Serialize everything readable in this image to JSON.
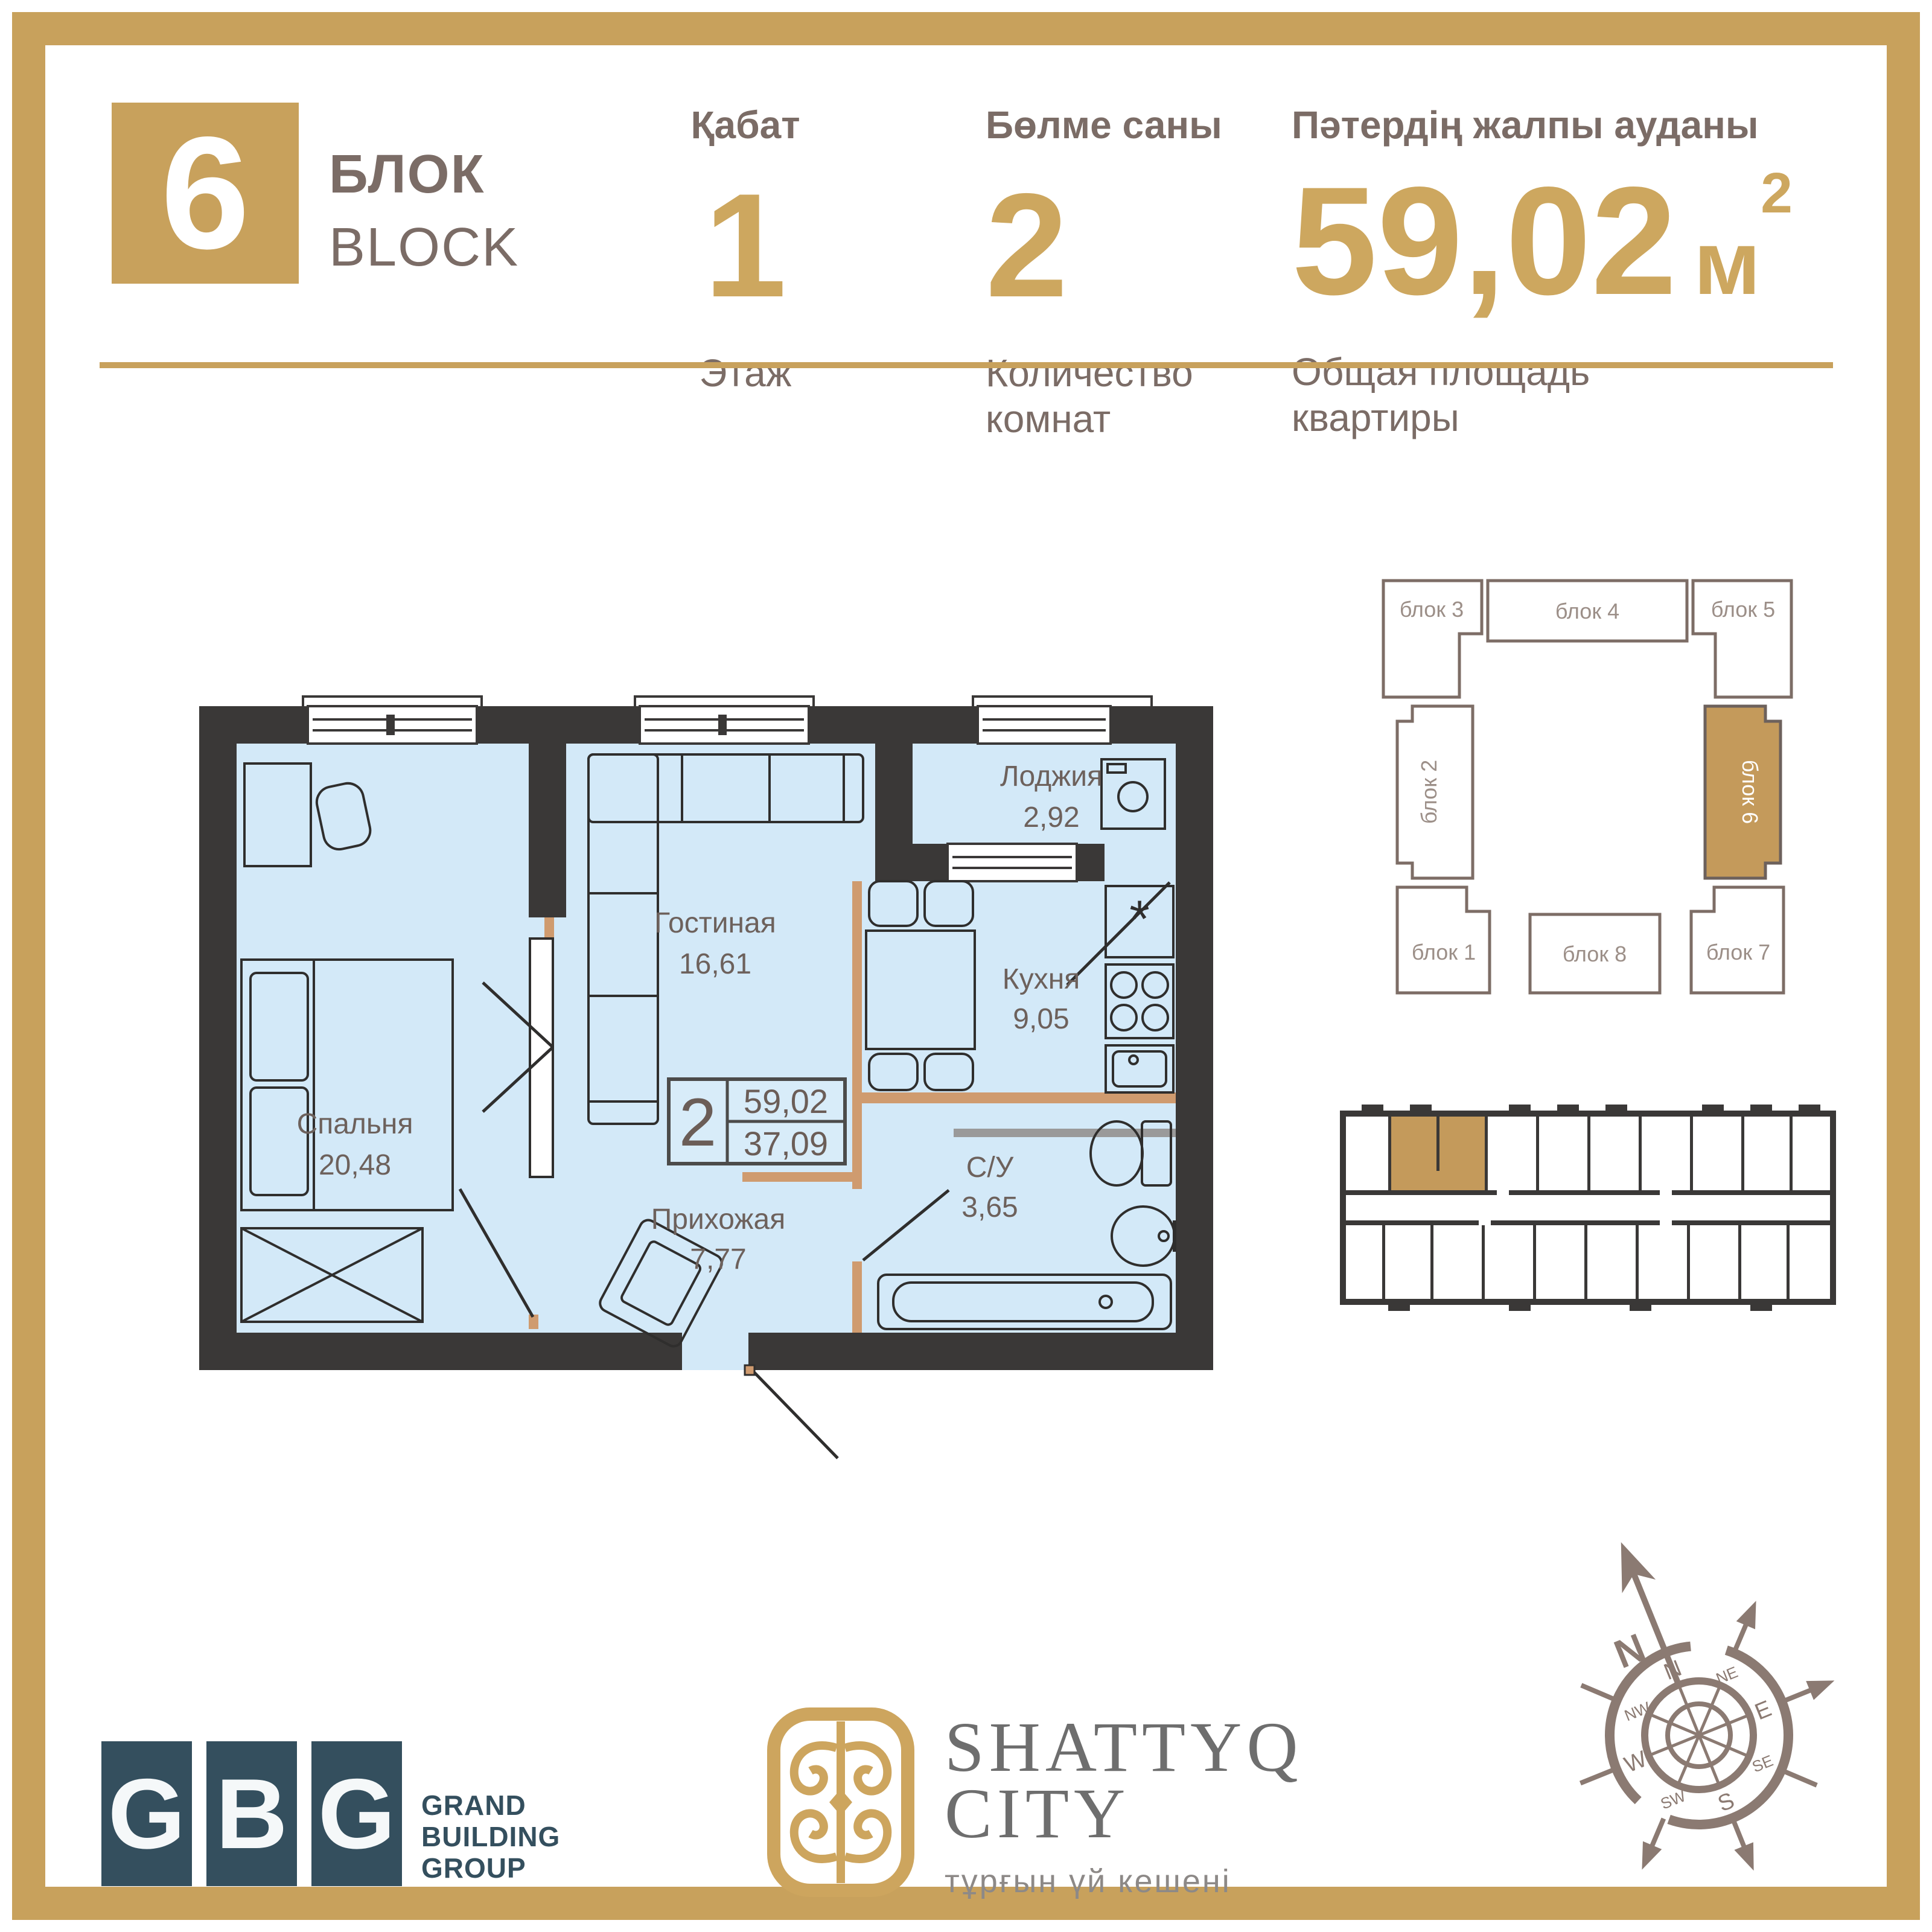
{
  "header": {
    "block_number": "6",
    "block_label_kk": "БЛОК",
    "block_label_en": "BLOCK",
    "floor": {
      "label_kk": "Қабат",
      "value": "1",
      "label_ru": "Этаж"
    },
    "rooms": {
      "label_kk": "Бөлме саны",
      "value": "2",
      "label_ru": "Количество комнат"
    },
    "area": {
      "label_kk": "Пәтердің жалпы ауданы",
      "value": "59,02",
      "unit": "м",
      "sup": "2",
      "label_ru_1": "Общая площадь",
      "label_ru_2": "квартиры"
    }
  },
  "floor_plan": {
    "rooms": [
      {
        "name": "Лоджия",
        "area": "2,92"
      },
      {
        "name": "Гостиная",
        "area": "16,61"
      },
      {
        "name": "Кухня",
        "area": "9,05"
      },
      {
        "name": "Спальня",
        "area": "20,48"
      },
      {
        "name": "Прихожая",
        "area": "7,77"
      },
      {
        "name": "С/У",
        "area": "3,65"
      }
    ],
    "info_box": {
      "rooms": "2",
      "total_area": "59,02",
      "living_area": "37,09"
    },
    "fridge_symbol": "*"
  },
  "block_scheme": {
    "blocks": [
      {
        "label": "блок 3"
      },
      {
        "label": "блок 4"
      },
      {
        "label": "блок 5"
      },
      {
        "label": "блок 2"
      },
      {
        "label": "блок 6",
        "highlighted": true
      },
      {
        "label": "блок 1"
      },
      {
        "label": "блок 8"
      },
      {
        "label": "блок 7"
      }
    ]
  },
  "footer": {
    "gbg": {
      "letters": [
        "G",
        "B",
        "G"
      ],
      "name_lines": [
        "GRAND",
        "BUILDING",
        "GROUP"
      ]
    },
    "shattyq": {
      "title_line1": "SHATTYQ",
      "title_line2": "CITY",
      "subtitle": "тұрғын үй кешені"
    },
    "compass": {
      "north_label": "N",
      "cardinals": [
        "N",
        "E",
        "S",
        "W"
      ],
      "intercardinals": [
        "NE",
        "SE",
        "SW",
        "NW"
      ]
    }
  },
  "colors": {
    "gold": "#c8a15c",
    "wall_dark": "#3a3837",
    "room_fill": "#d3e9f8",
    "partition_tan": "#cf9b6f",
    "gbg_teal": "#344f5e",
    "scheme_stroke": "#7d6d66",
    "compass": "#8b7a72"
  }
}
